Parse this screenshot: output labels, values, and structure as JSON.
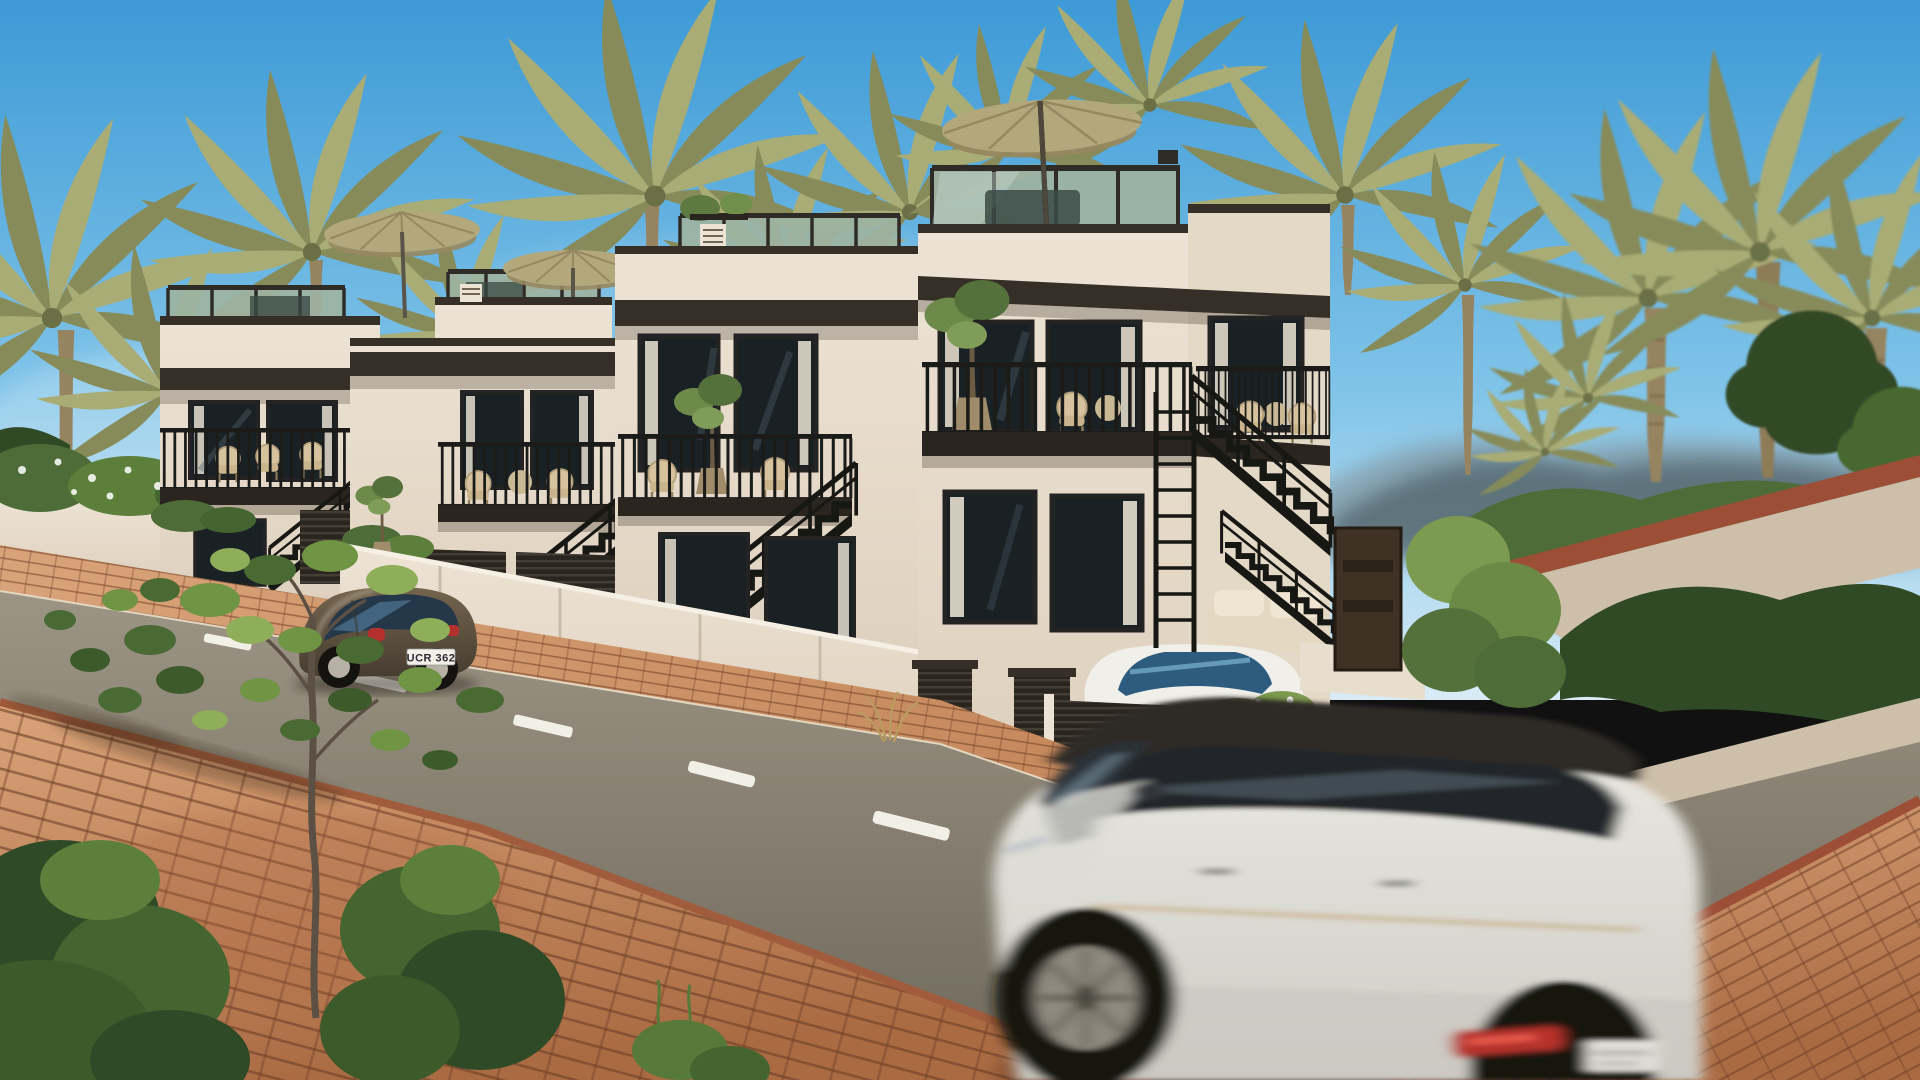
{
  "image": {
    "type": "architectural-render",
    "description": "Sunny street view of a row of four modern white multi-storey townhouses with rooftop terraces, tan patio umbrellas, black steel staircases and balconies, palm trees, terracotta brick sidewalks, a parked bronze Beetle coupe and a motion-blurred white SUV driving past.",
    "width": 1920,
    "height": 1080
  },
  "palette": {
    "sky_top": "#3D9AD6",
    "sky_mid": "#7FC3E8",
    "sky_horizon": "#D8ECF6",
    "hills": "#55666E",
    "hills_light": "#7E909A",
    "palm_frond_light": "#A9AC75",
    "palm_frond_dark": "#878B5A",
    "palm_trunk": "#96835F",
    "foliage_dark": "#314A26",
    "foliage_mid": "#4E6C38",
    "foliage_light": "#7C9A50",
    "flower_white": "#FFFFFF",
    "wall_lit": "#EDE3D4",
    "wall_shaded": "#D9CBBA",
    "fascia_dark": "#352F27",
    "window_glass": "#1A2125",
    "window_frame": "#232323",
    "curtain": "#E6DECF",
    "glass_reflection": "#51656F",
    "roof_glass": "#9DB3A2",
    "roof_glass_frame": "#2F2C28",
    "railing_black": "#1B1B19",
    "umbrella_tan": "#B3A77C",
    "umbrella_shade": "#97885F",
    "garage_louver": "#2A251F",
    "louver_line": "#4A443A",
    "brick_light": "#D9A379",
    "brick_mid": "#C08255",
    "brick_dark": "#AA6B43",
    "brick_joint": "#6E3F28",
    "curb_red": "#9C4F36",
    "road_far": "#9C9484",
    "road_near": "#6F695C",
    "road_marking": "#F2EFE6",
    "ramp_concrete": "#CDBFA9",
    "beetle_body": "#75654F",
    "beetle_window": "#24384A",
    "suv_body": "#E9E8E2",
    "suv_roof": "#2E2B26",
    "suv_glass": "#20262B",
    "taillight_red": "#B5302C",
    "plate_white": "#F2F0E8",
    "door_brown": "#3F3224",
    "pot_tan": "#A08C6B",
    "wicker": "#D6C29C",
    "sofa_beige": "#E4D8C2",
    "white_car": "#F0EFEA",
    "white_car_glass": "#2E5C7E",
    "shadow": "#1A140C"
  },
  "scene": {
    "sky": {
      "condition": "clear sunny blue sky"
    },
    "background": {
      "hills": "soft blurred coastal hills on the right horizon",
      "vegetation": "date palms and leafy green trees behind and beside the houses",
      "hedge_row": "trimmed hedges along the rear walkway"
    },
    "buildings": {
      "type": "row of modern white townhouses",
      "count": 4,
      "units": [
        {
          "name": "townhouse-1",
          "position": "far left",
          "features": [
            "rooftop terrace with tinted glass balustrade",
            "tan patio umbrella",
            "balcony with black railing and chairs",
            "external black steel staircase",
            "garden wall with hedges"
          ]
        },
        {
          "name": "townhouse-2",
          "position": "centre left",
          "features": [
            "rooftop terrace with tan patio umbrella",
            "balcony with outdoor chairs",
            "double dark louvred garage doors",
            "external black steel staircase"
          ]
        },
        {
          "name": "townhouse-3",
          "position": "centre",
          "features": [
            "rooftop terrace with glass balustrade and planters",
            "sliding glass doors with curtains",
            "balcony with wicker chairs and potted olive tree",
            "external black steel staircase",
            "louvred planter boxes"
          ]
        },
        {
          "name": "townhouse-4",
          "position": "right, closest",
          "features": [
            "tall rooftop terrace with large tan umbrella",
            "tinted glass balustrade",
            "deep dark roof fascia",
            "balcony with potted olive tree and bistro set",
            "gated driveway with parked white car",
            "black entry staircase",
            "dark brown front door",
            "garden wall with trailing white-flowering plant",
            "dark louvred vent"
          ]
        }
      ]
    },
    "street": {
      "road": "asphalt street sloping down to the right",
      "lane_marking": "white dashed centre line",
      "near_sidewalk": "terracotta brick paver sidewalk, bottom left",
      "far_sidewalk": "sunlit brick paver strip along the houses",
      "ramp": "paved walkway with red brick edge rising to the right",
      "corner_paving": "brick paving in the bottom right corner"
    },
    "vehicles": {
      "beetle": {
        "label": "bronze Beetle style coupe",
        "state": "parked at the far curb facing away",
        "license_plate": "UCR 362"
      },
      "suv": {
        "label": "white SUV with black roof",
        "state": "driving past in the foreground, motion blurred",
        "license_plate": "illegible (motion blur)"
      },
      "compact": {
        "label": "small white car",
        "state": "parked behind the louvred driveway gate of townhouse-4"
      }
    },
    "foreground": {
      "tree": "young olive tree growing from the brick sidewalk",
      "bushes": "dark green shrubs at the bottom left",
      "hanging_plant": "white-flowering trailing plant over the garden wall",
      "grass_tuft": "dry grass tuft at the kerb"
    }
  }
}
